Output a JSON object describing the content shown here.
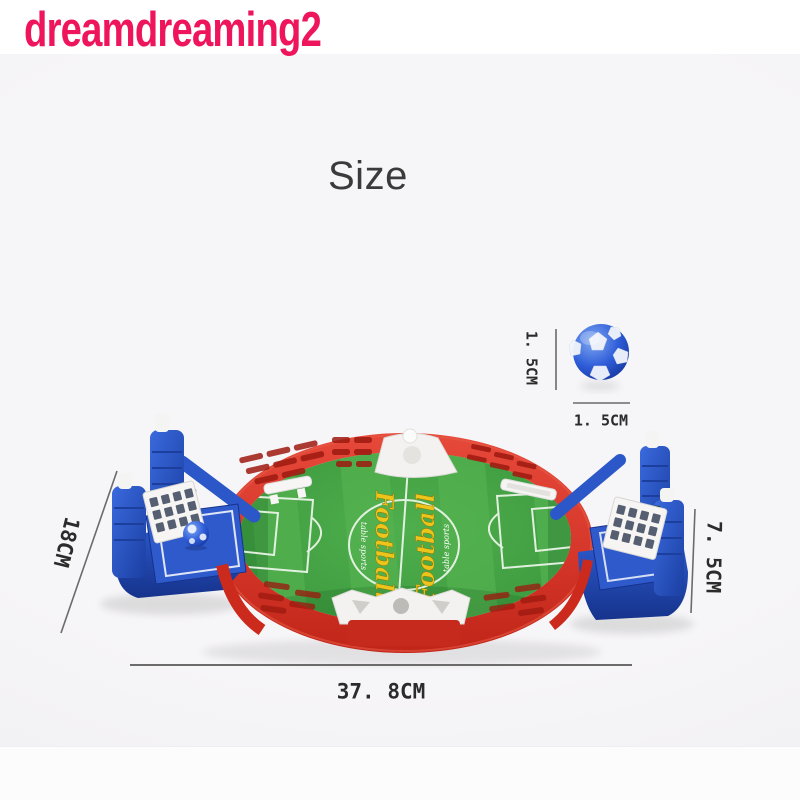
{
  "watermark": {
    "text": "dreamdreaming2",
    "color": "#ee155c"
  },
  "title": "Size",
  "product": {
    "logo_text": "Football",
    "logo_subtext": "table sports",
    "colors": {
      "frame_red": "#d5372a",
      "field_green": "#3f9d41",
      "goal_blue": "#2b57c8",
      "logo_yellow": "#edc41c",
      "ball_blue": "#2e5cd8"
    }
  },
  "dimensions": {
    "board_length": "37. 8CM",
    "board_depth": "18CM",
    "board_height": "7. 5CM",
    "ball_height": "1. 5CM",
    "ball_width": "1. 5CM"
  }
}
